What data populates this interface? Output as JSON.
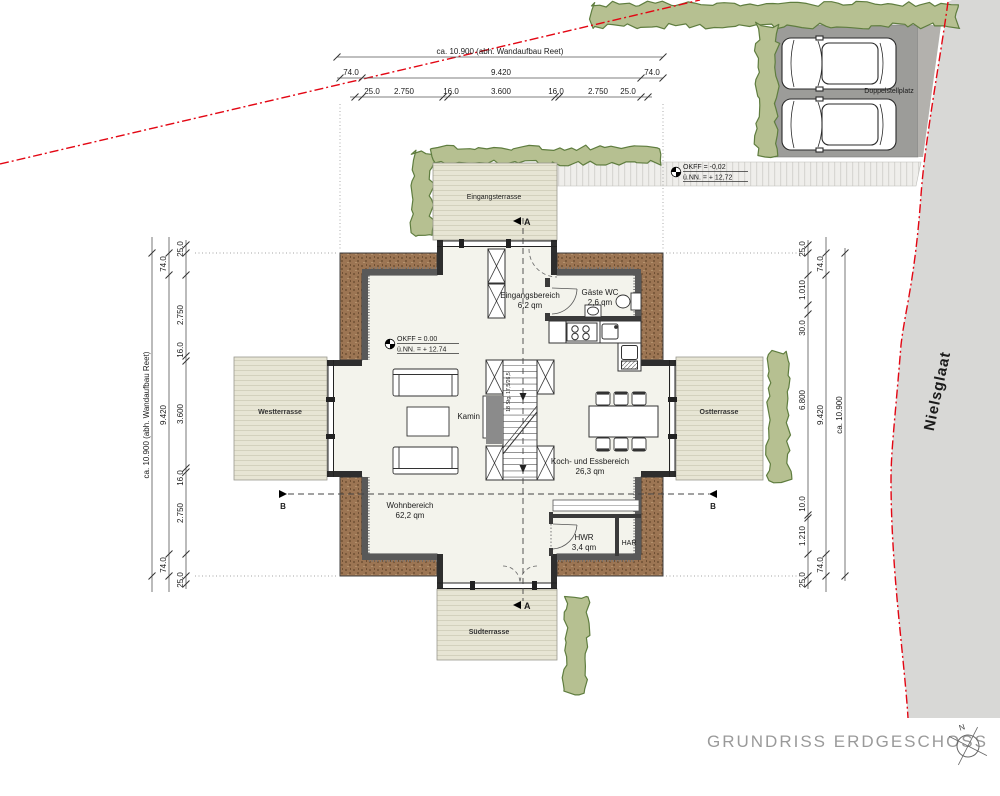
{
  "title": "GRUNDRISS ERDGESCHOSS",
  "compass": {
    "north": "N"
  },
  "street": {
    "name": "Nielsglaat"
  },
  "parking": {
    "label": "Doppelstellplatz"
  },
  "levels": {
    "outside": {
      "l1": "OKFF =   -0,02",
      "l2": "ü.NN. = + 12,72"
    },
    "inside": {
      "l1": "OKFF =    0.00",
      "l2": "ü.NN. = + 12.74"
    }
  },
  "rooms": {
    "entry_terrace": "Eingangsterrasse",
    "entry": {
      "name": "Eingangsbereich",
      "area": "6,2 qm"
    },
    "wc": {
      "name": "Gäste WC",
      "area": "2,6 qm"
    },
    "cook_dine": {
      "name": "Koch- und Essbereich",
      "area": "26,3 qm"
    },
    "living": {
      "name": "Wohnbereich",
      "area": "62,2 qm"
    },
    "hwr": {
      "name": "HWR",
      "area": "3,4 qm"
    },
    "har": {
      "name": "HAR"
    },
    "fireplace": "Kamin",
    "west_terrace": "Westterrasse",
    "east_terrace": "Ostterrasse",
    "south_terrace": "Südterrasse"
  },
  "stairs": {
    "note": "18 Stg. 17,5/26,5"
  },
  "sections": {
    "a": "A",
    "b": "B"
  },
  "dimensions": {
    "top": {
      "overall": "ca. 10.900 (abh. Wandaufbau Reet)",
      "mid": [
        "74.0",
        "9.420",
        "74.0"
      ],
      "inner": [
        "25.0",
        "2.750",
        "16.0",
        "3.600",
        "16.0",
        "2.750",
        "25.0"
      ]
    },
    "left": {
      "overall": "ca. 10.900 (abh. Wandaufbau Reet)",
      "mid": [
        "74.0",
        "9.420",
        "74.0"
      ],
      "inner": [
        "25.0",
        "2.750",
        "16.0",
        "3.600",
        "16.0",
        "2.750",
        "25.0"
      ]
    },
    "right": {
      "overall": "ca. 10.900",
      "mid": [
        "74.0",
        "9.420",
        "74.0"
      ],
      "inner": [
        "25.0",
        "1.010",
        "30.0",
        "6.800",
        "10.0",
        "1.210",
        "25.0"
      ]
    }
  },
  "colors": {
    "boundary_red": "#e30613",
    "thatch_brown": "#9c7553",
    "hedge_green": "#b6c091",
    "terrace_beige": "#e7e5d4",
    "parking_gray": "#9c9c99",
    "street_gray": "#d8d8d6"
  }
}
